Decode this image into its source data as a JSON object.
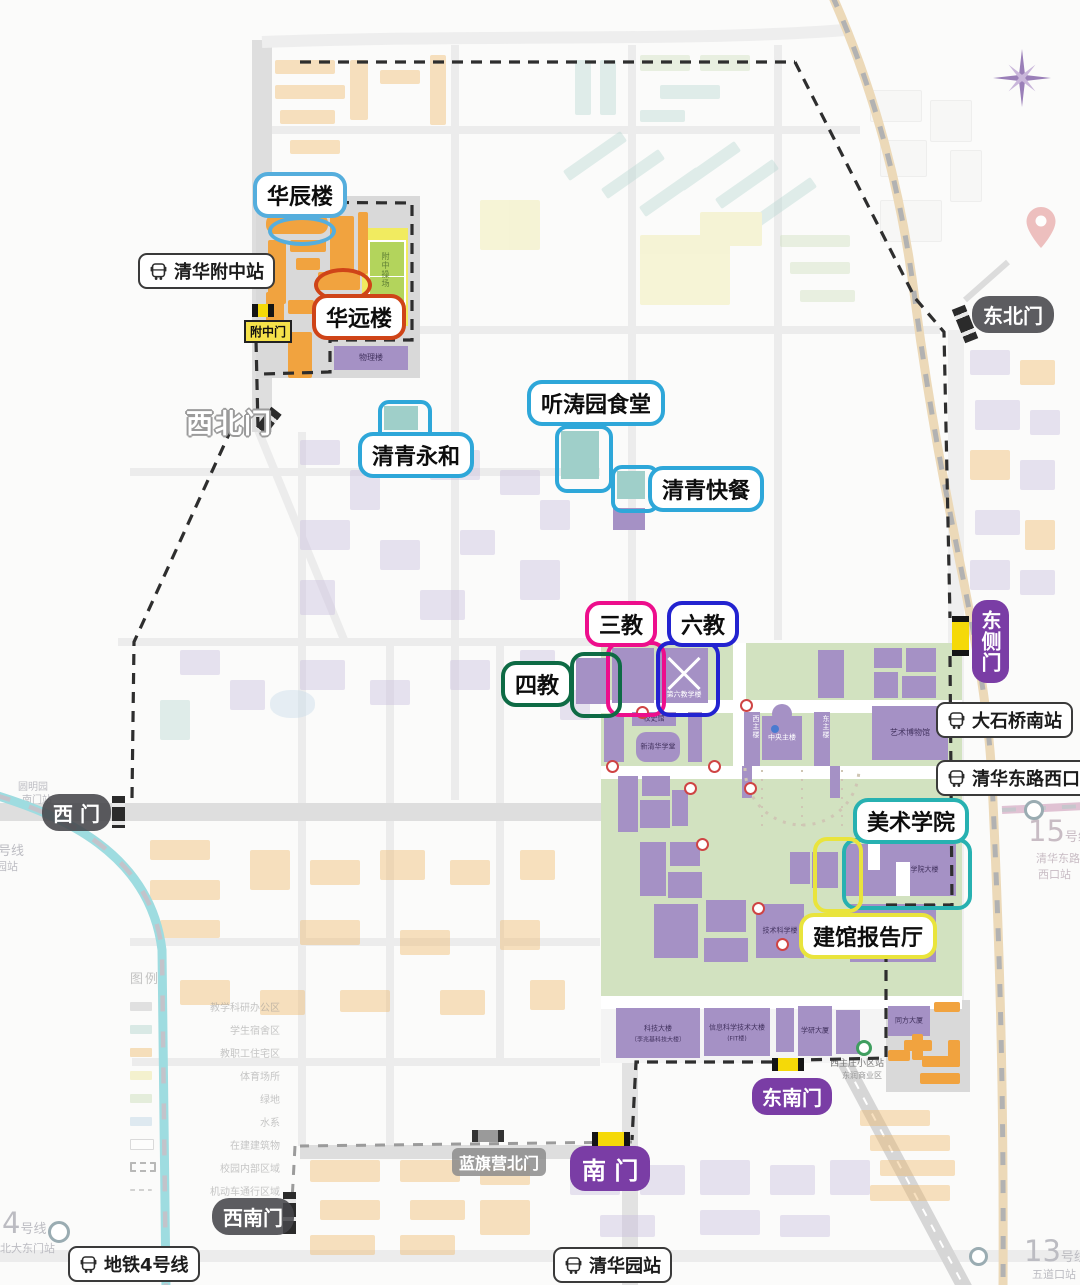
{
  "callouts": {
    "huachen": {
      "label": "华辰楼",
      "color": "#55aedd"
    },
    "huayuan": {
      "label": "华远楼",
      "color": "#cf4418"
    },
    "yonghe": {
      "label": "清青永和",
      "color": "#2ea7d9"
    },
    "tingtao": {
      "label": "听涛园食堂",
      "color": "#2ea7d9"
    },
    "kuaican": {
      "label": "清青快餐",
      "color": "#2ea7d9"
    },
    "sanjiao": {
      "label": "三教",
      "color": "#ed0e8c"
    },
    "liujiao": {
      "label": "六教",
      "color": "#2323d0"
    },
    "sijiao": {
      "label": "四教",
      "color": "#0e6b45"
    },
    "meiyuan": {
      "label": "美术学院",
      "color": "#27b1b1"
    },
    "jianguan": {
      "label": "建馆报告厅",
      "color": "#e9e43c"
    }
  },
  "gates": {
    "fuzhongmen": "附中门",
    "xibeimen": "西北门",
    "dongbeimen": "东北门",
    "dongcemen": "东侧门",
    "ximen": "西 门",
    "dongnanmen": "东南门",
    "nanmen": "南 门",
    "lanqiying": "蓝旗营北门",
    "xinanmen": "西南门"
  },
  "bus_stops": {
    "fuzhong": "清华附中站",
    "dashiqiao": "大石桥南站",
    "donglu_xikou": "清华东路西口站",
    "ditie4": "地铁4号线",
    "qinghuayuan": "清华园站",
    "xizhuzhuang": "西主庄小区站",
    "dongrun": "东润商业区"
  },
  "buildings": {
    "wuli": "物理楼",
    "fuzhong_field": "附中操场",
    "xiaoshiguan": "校史馆",
    "xinqinghua": "新清华学堂",
    "zhulou": "中央主楼",
    "xizhulou": "西主楼",
    "dongzhulou": "东主楼",
    "liujiao_bld": "第六教学楼",
    "yishubwg": "艺术博物馆",
    "meiyuan_bld": "美术学院大楼",
    "jishukexue": "技术科学楼",
    "huanjing": "环境学院",
    "keji_a": "科技大楼",
    "keji_b": "〔李兆基科技大楼〕",
    "fit_a": "信息科学技术大楼",
    "fit_b": "(FIT楼)",
    "xueyan": "学研大厦",
    "tongfang": "同方大厦"
  },
  "metro": {
    "line4_num": "4",
    "line4_suffix": "号线",
    "beida_dongmen": "北大东门站",
    "yuanmingyuan_a": "圆明园",
    "yuanmingyuan_b": "南门站",
    "yuanmingyuan_zhan": "圆明园站",
    "line15_num": "15",
    "line15_suffix": "号线",
    "donglu_a": "清华东路",
    "donglu_b": "西口站",
    "line13_num": "13",
    "line13_suffix": "号线",
    "wudaokou": "五道口站"
  },
  "legend": {
    "title": "图例",
    "items": [
      "教学科研办公区",
      "学生宿舍区",
      "教职工住宅区",
      "体育场所",
      "绿地",
      "水系",
      "在建建筑物",
      "校园内部区域",
      "机动车通行区域"
    ]
  }
}
